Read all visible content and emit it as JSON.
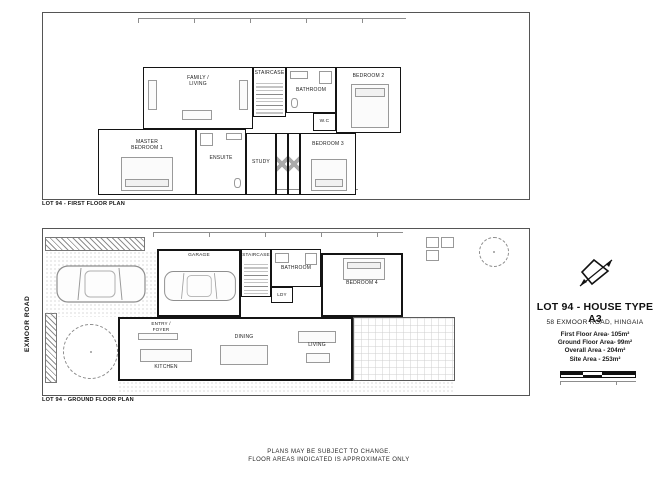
{
  "sheet": {
    "title": "LOT 94 - HOUSE TYPE A3",
    "address": "58 EXMOOR ROAD, HINGAIA",
    "areas": {
      "first_floor": "First Floor Area-  105m²",
      "ground_floor": "Ground Floor Area- 99m²",
      "overall": "Overall Area - 204m²",
      "site": "Site Area - 253m²"
    },
    "notes_line1": "PLANS MAY BE SUBJECT TO CHANGE.",
    "notes_line2": "FLOOR AREAS INDICATED IS APPROXIMATE ONLY",
    "road_label": "EXMOOR ROAD",
    "colors": {
      "wall": "#141414",
      "accent": "#8f8f8f"
    }
  },
  "first_floor_plan": {
    "caption": "LOT 94 - FIRST FLOOR PLAN",
    "rooms": {
      "family_living": "FAMILY /\nLIVING",
      "staircase": "STAIRCASE",
      "bathroom": "BATHROOM",
      "wc": "W.C",
      "bedroom2": "BEDROOM 2",
      "hallway": "HALLWAY",
      "master_bedroom1": "MASTER\nBEDROOM 1",
      "ensuite": "ENSUITE",
      "study": "STUDY",
      "bedroom3": "BEDROOM 3"
    }
  },
  "ground_floor_plan": {
    "caption": "LOT 94 - GROUND FLOOR PLAN",
    "rooms": {
      "garage": "GARAGE",
      "staircase": "STAIRCASE",
      "bathroom": "BATHROOM",
      "ldy": "LDY",
      "bedroom4": "BEDROOM 4",
      "entry": "ENTRY /\nFOYER",
      "kitchen": "KITCHEN",
      "dining": "DINING",
      "living": "LIVING"
    }
  }
}
